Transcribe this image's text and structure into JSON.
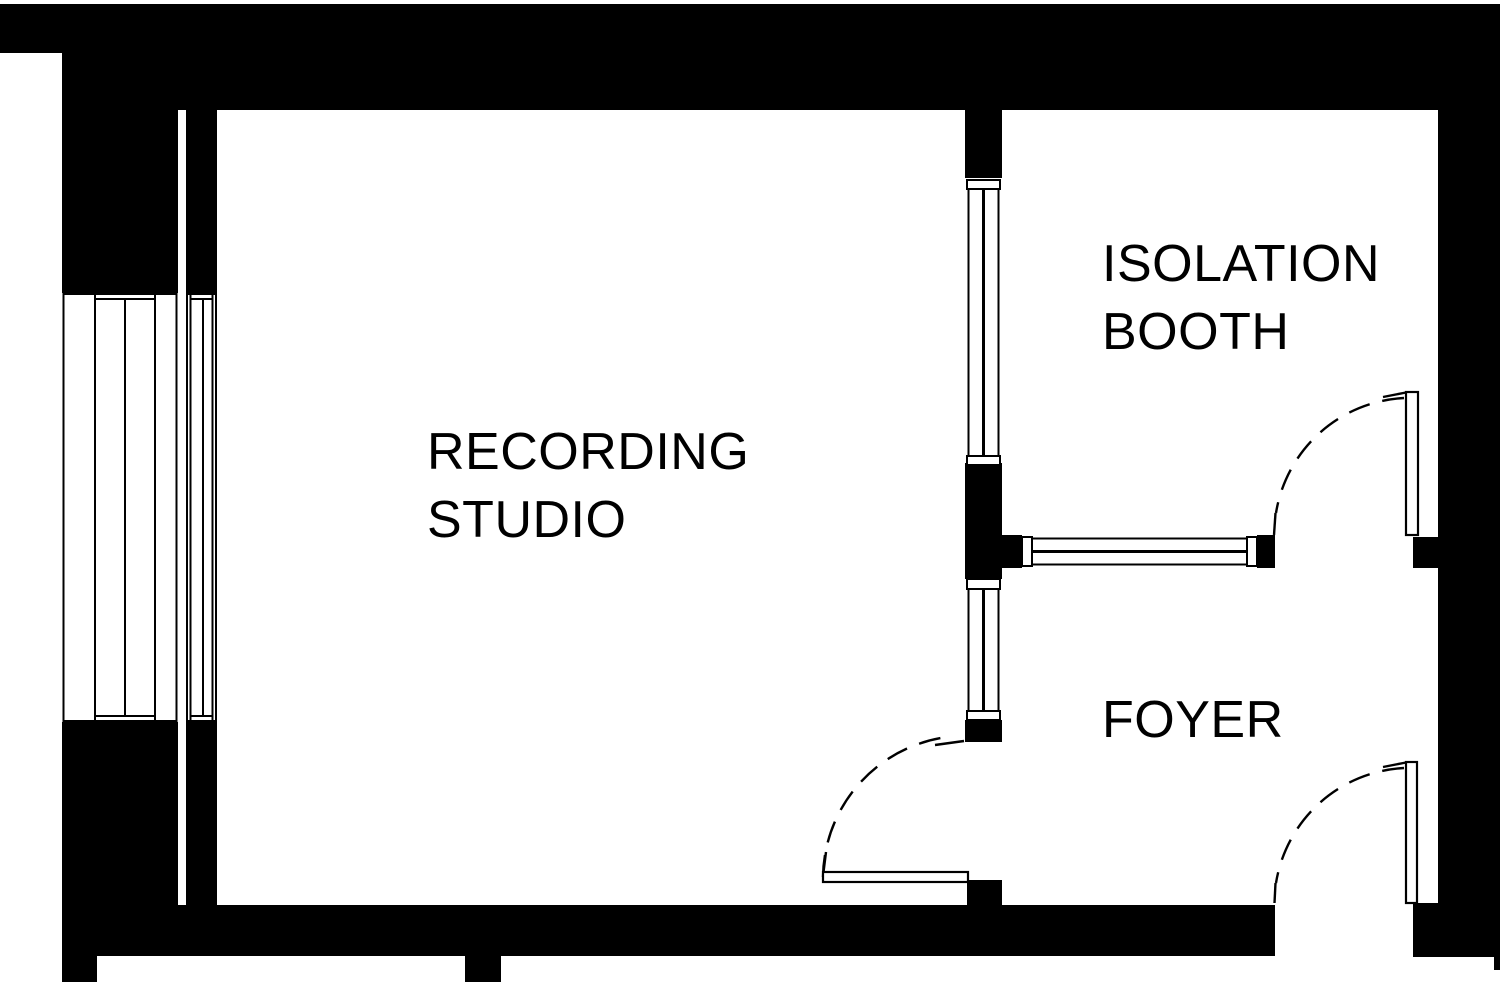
{
  "colors": {
    "ink": "#000000",
    "background": "#ffffff"
  },
  "rooms": {
    "recording_studio": {
      "label_line1": "RECORDING",
      "label_line2": "STUDIO"
    },
    "isolation_booth": {
      "label_line1": "ISOLATION",
      "label_line2": "BOOTH"
    },
    "foyer": {
      "label": "FOYER"
    }
  }
}
